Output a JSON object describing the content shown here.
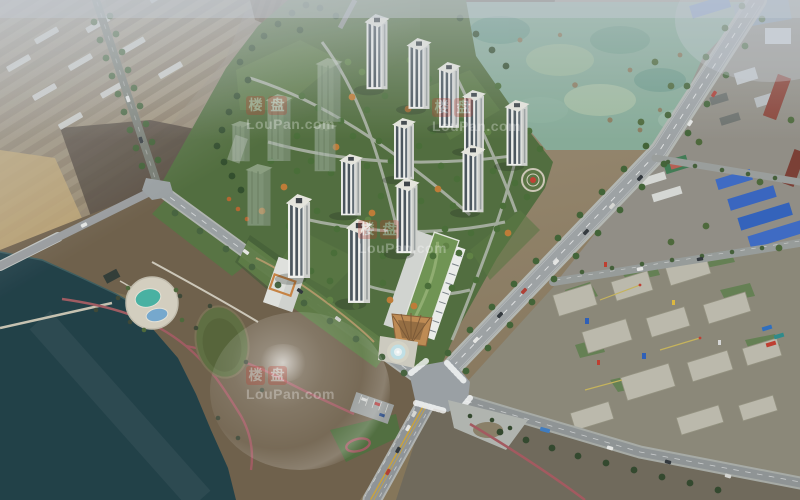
{
  "watermark": {
    "char1": "楼",
    "char2": "盘",
    "domain": "LouPan.com"
  },
  "colors": {
    "water": "#1c3b43",
    "park_ground": "#6d5d47",
    "development_green": "#4f6b3a",
    "road_asphalt": "#9aa0a2",
    "cleared_land_teal": "#86ab97",
    "construction_ground": "#8b8677",
    "tower_facade": "#f3f3f0",
    "industrial_blue_roof": "#3a68c4",
    "pond_teal": "#45b2a2",
    "pond_blue": "#74a8cf",
    "green_pond": "#5c6c3e",
    "sculpture_red": "#c23b2e",
    "autumn_tree": "#c07a32",
    "tree_green": "#3d5c30",
    "watermark_red": "#c23b2e"
  }
}
